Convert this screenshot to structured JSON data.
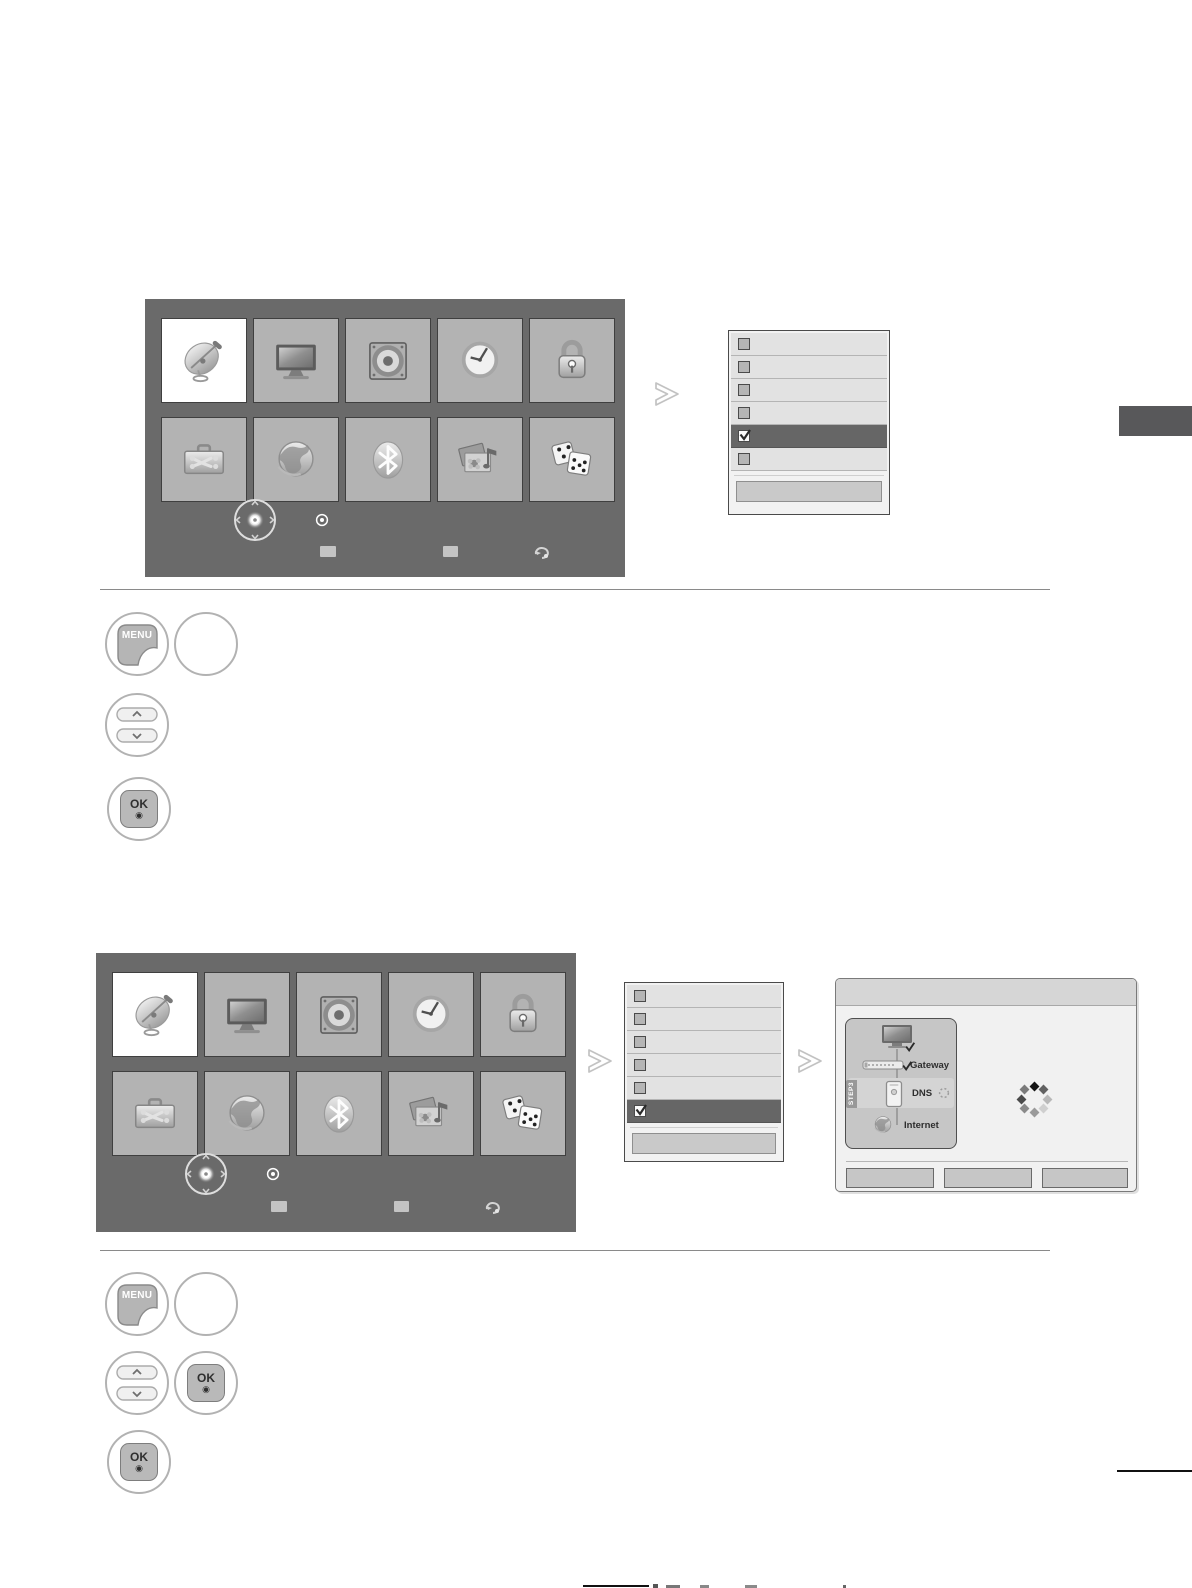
{
  "remote": {
    "menu_key": "MENU",
    "ok_key": "OK",
    "ok_symbol": "◉"
  },
  "menu_screen": {
    "icon_names": [
      "satellite-dish",
      "tv",
      "speaker",
      "clock",
      "padlock",
      "toolbox",
      "globe",
      "bluetooth",
      "photo-music",
      "dice"
    ],
    "selected_tile_index": 0,
    "colors": {
      "screen_bg": "#6a6a6a",
      "tile_bg": "#b3b3b3",
      "selected_tile_bg": "#ffffff",
      "highlight_row_bg": "#666666"
    }
  },
  "option_list_1": {
    "rows": 6,
    "highlighted_row": 5,
    "checked_row": 5
  },
  "option_list_2": {
    "rows": 6,
    "highlighted_row": 6,
    "checked_row": 6
  },
  "network_status_panel": {
    "gateway_label": "Gateway",
    "dns_label": "DNS",
    "internet_label": "Internet",
    "step_badge": "STEP3",
    "button_count": 3
  }
}
